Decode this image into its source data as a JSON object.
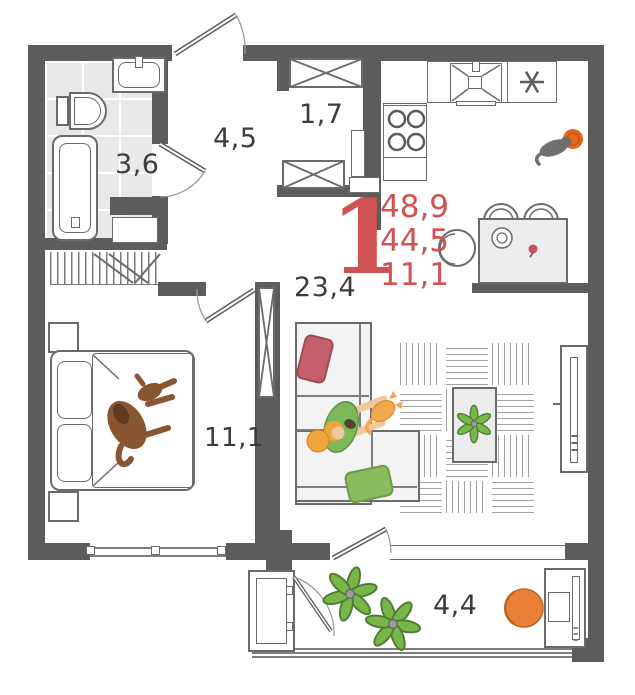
{
  "unit": {
    "rooms_count": "1",
    "area_lines": [
      "48,9",
      "44,5",
      "11,1"
    ],
    "accent_color": "#d05252"
  },
  "room_areas": {
    "bathroom": "3,6",
    "hallway": "4,5",
    "storage": "1,7",
    "living_kitchen": "23,4",
    "bedroom": "11,1",
    "balcony": "4,4"
  },
  "icons": {
    "bathtub": "bathtub-icon",
    "toilet": "toilet-icon",
    "washbasin": "washbasin-icon",
    "kitchen_sink": "kitchen-sink-icon",
    "fridge": "snowflake-icon",
    "stove": "four-burner-stove-icon",
    "wardrobe": "crossed-wardrobe-icon",
    "coat_rack": "coat-rack-icon",
    "sofa": "sofa-icon",
    "bed": "double-bed-icon",
    "dog": "dog-icon",
    "cat": "cat-icon",
    "person": "person-icon",
    "plant": "potted-plant-icon",
    "tv": "tv-icon",
    "dining_table": "dining-table-icon",
    "desk_chair": "office-chair-icon"
  },
  "colors": {
    "walls": "#5c5c5c",
    "accent_red": "#d05252",
    "plant_green": "#77b648",
    "orange": "#ea8038",
    "pillow_red": "#c5606b",
    "pillow_green": "#8abb5f",
    "dog_brown": "#8a5531",
    "shirt_green": "#7db85a",
    "hair_orange": "#f0a43c",
    "floor_tile": "#e9e9e9"
  }
}
